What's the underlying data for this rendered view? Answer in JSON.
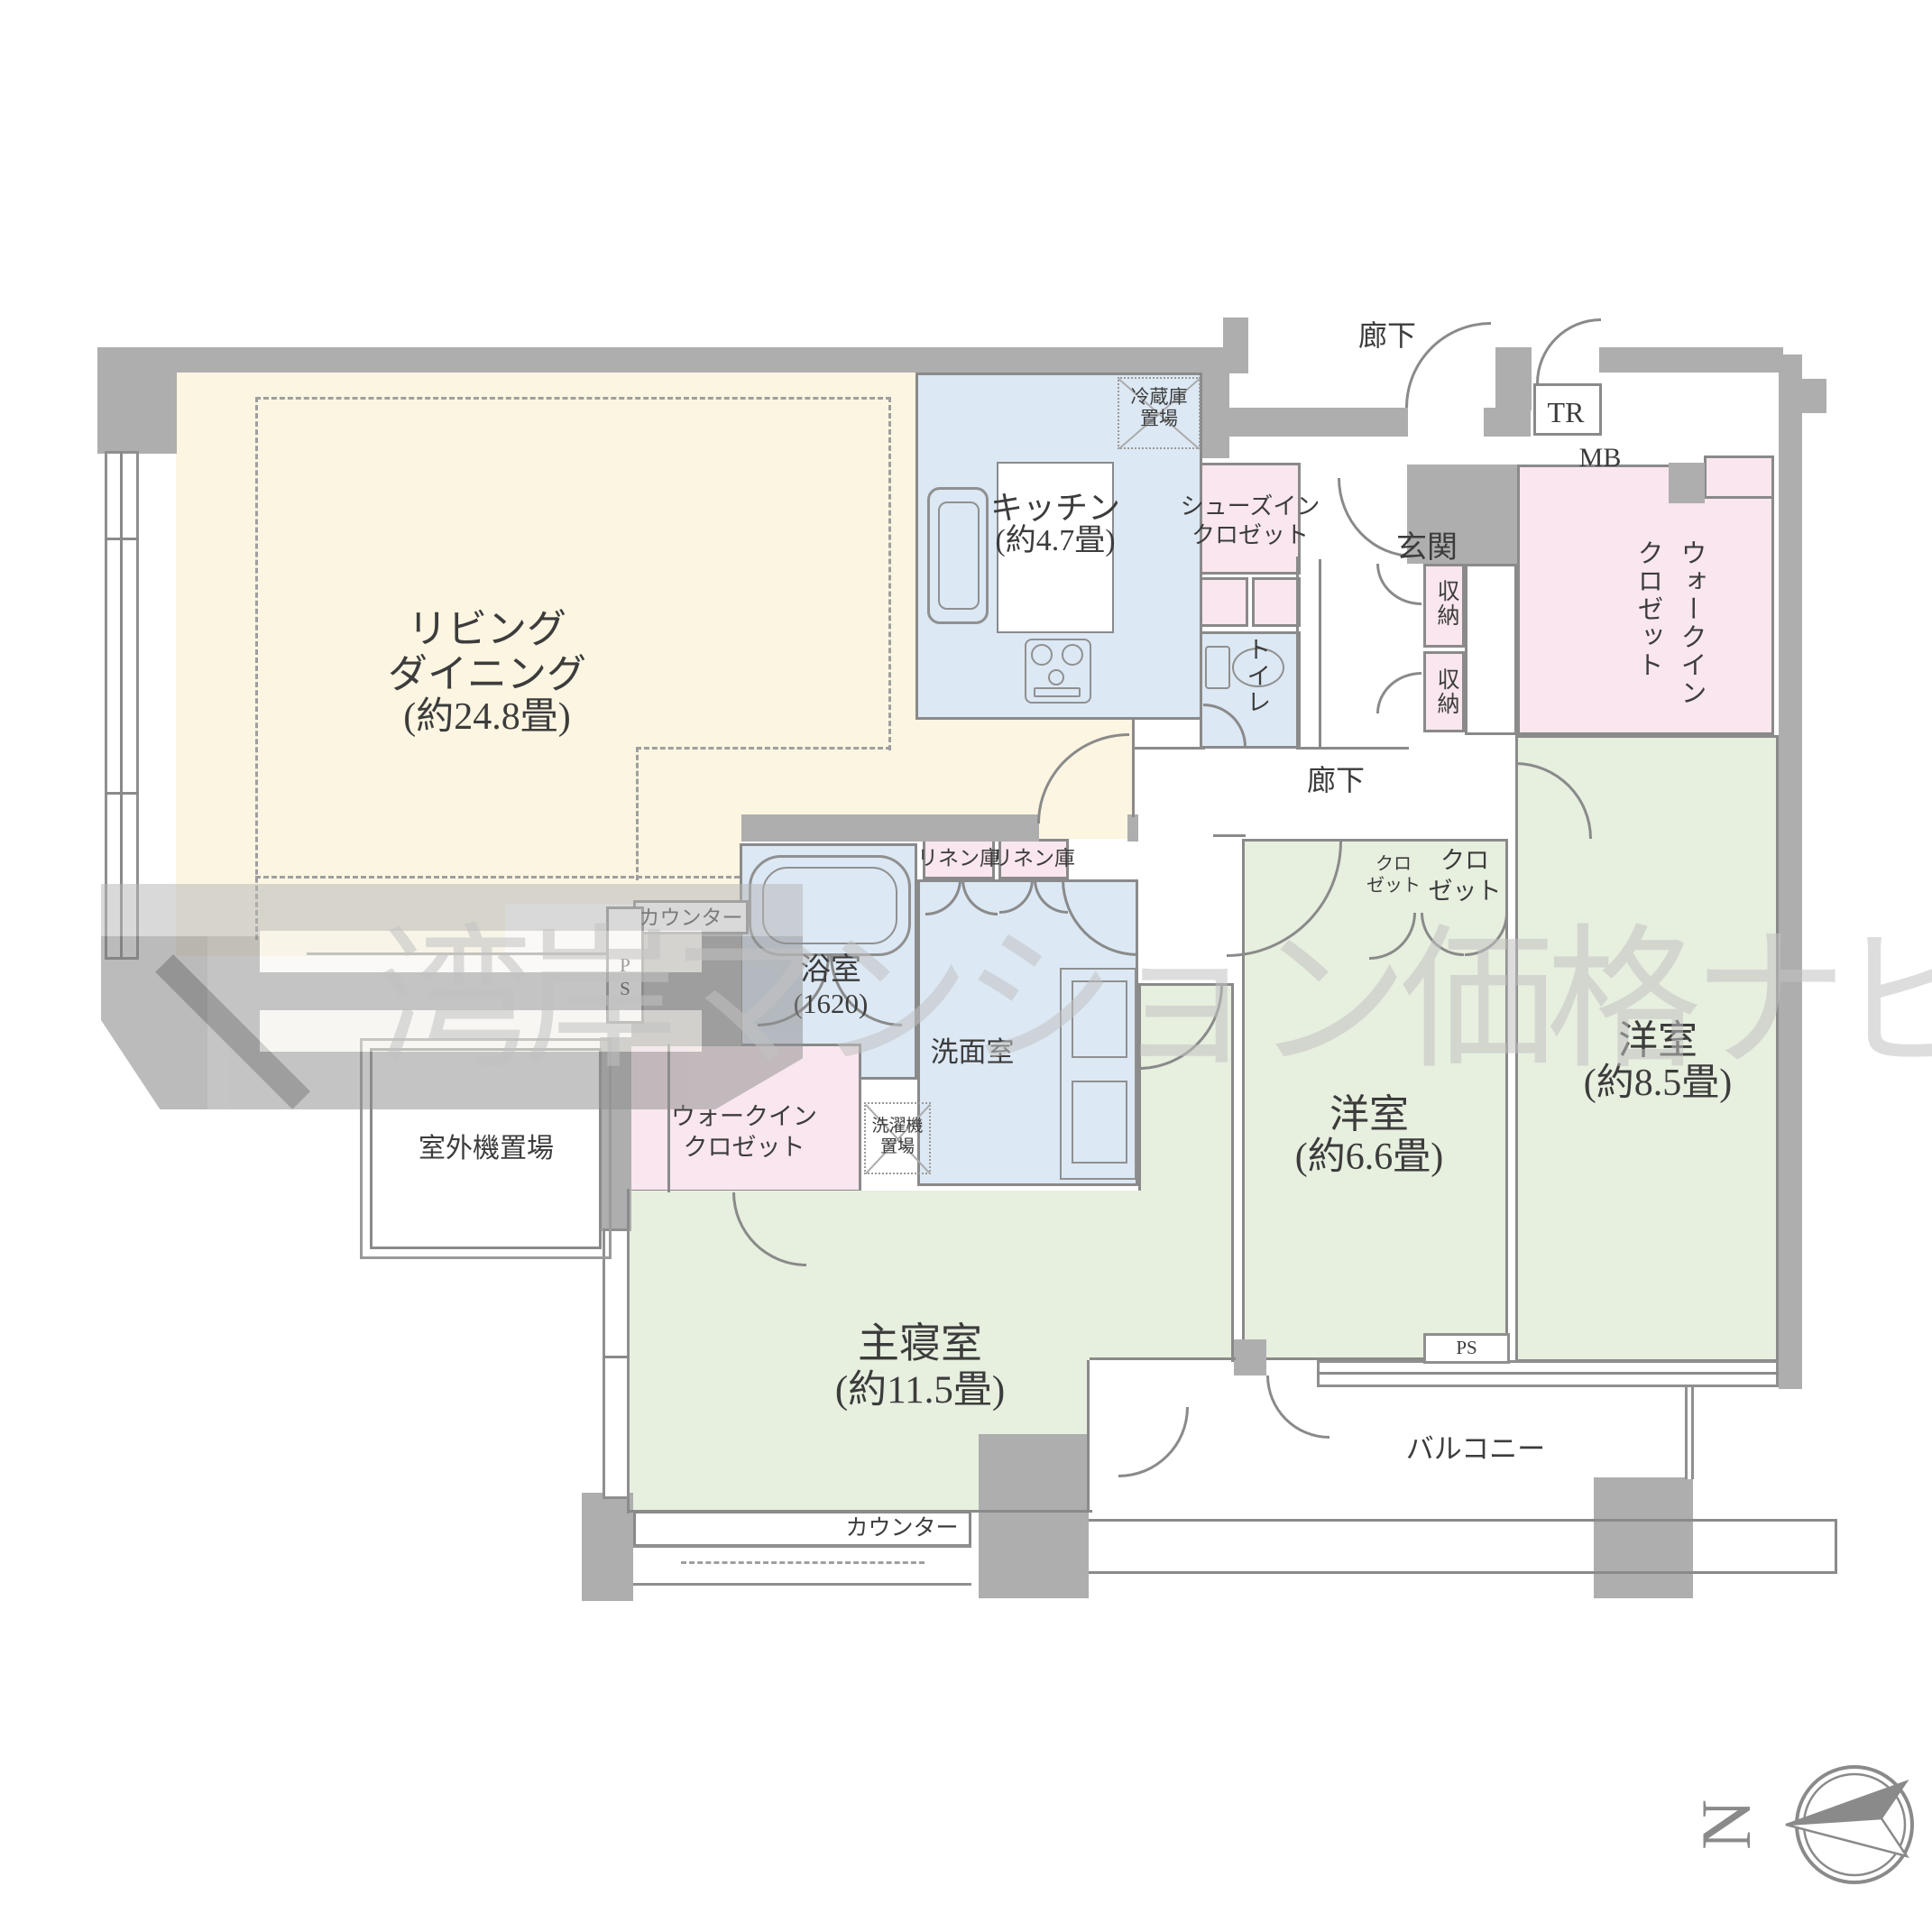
{
  "watermark": {
    "text": "湾岸マンション価格ナビ"
  },
  "compass": {
    "north": "N"
  },
  "colors": {
    "living": "#FBF5E1",
    "wet_area": "#DCE8F4",
    "closet": "#F9E6EE",
    "bedroom": "#E7EFDF",
    "wall": "#AEAEAE",
    "outline": "#8A8A8A",
    "watermark": "#C2C2C2"
  },
  "labels": {
    "living1": "リビング",
    "living2": "ダイニング",
    "living_size": "(約24.8畳)",
    "kitchen": "キッチン",
    "kitchen_size": "(約4.7畳)",
    "fridge1": "冷蔵庫",
    "fridge2": "置場",
    "shoes1": "シューズイン",
    "shoes2": "クロゼット",
    "toilet": "トイレ",
    "entrance": "玄関",
    "corridor_top": "廊下",
    "corridor_mid": "廊下",
    "tr": "TR",
    "mb": "MB",
    "storage_a": "収納",
    "storage_b": "収納",
    "wic_right1": "ウォークイン",
    "wic_right2": "クロゼット",
    "linen_a": "リネン庫",
    "linen_b": "リネン庫",
    "bath": "浴室",
    "bath_size": "(1620)",
    "washroom": "洗面室",
    "laundry1": "洗濯機",
    "laundry2": "置場",
    "closet_a1": "クロ",
    "closet_a2": "ゼット",
    "closet_b1": "クロ",
    "closet_b2": "ゼット",
    "western66": "洋室",
    "western66_size": "(約6.6畳)",
    "western85": "洋室",
    "western85_size": "(約8.5畳)",
    "wic_left1": "ウォークイン",
    "wic_left2": "クロゼット",
    "master": "主寝室",
    "master_size": "(約11.5畳)",
    "counter_living": "カウンター",
    "counter_bedroom": "カウンター",
    "ps_shaft1": "P",
    "ps_shaft2": "S",
    "ps_bottom": "PS",
    "balcony": "バルコニー",
    "outdoor_unit": "室外機置場"
  }
}
